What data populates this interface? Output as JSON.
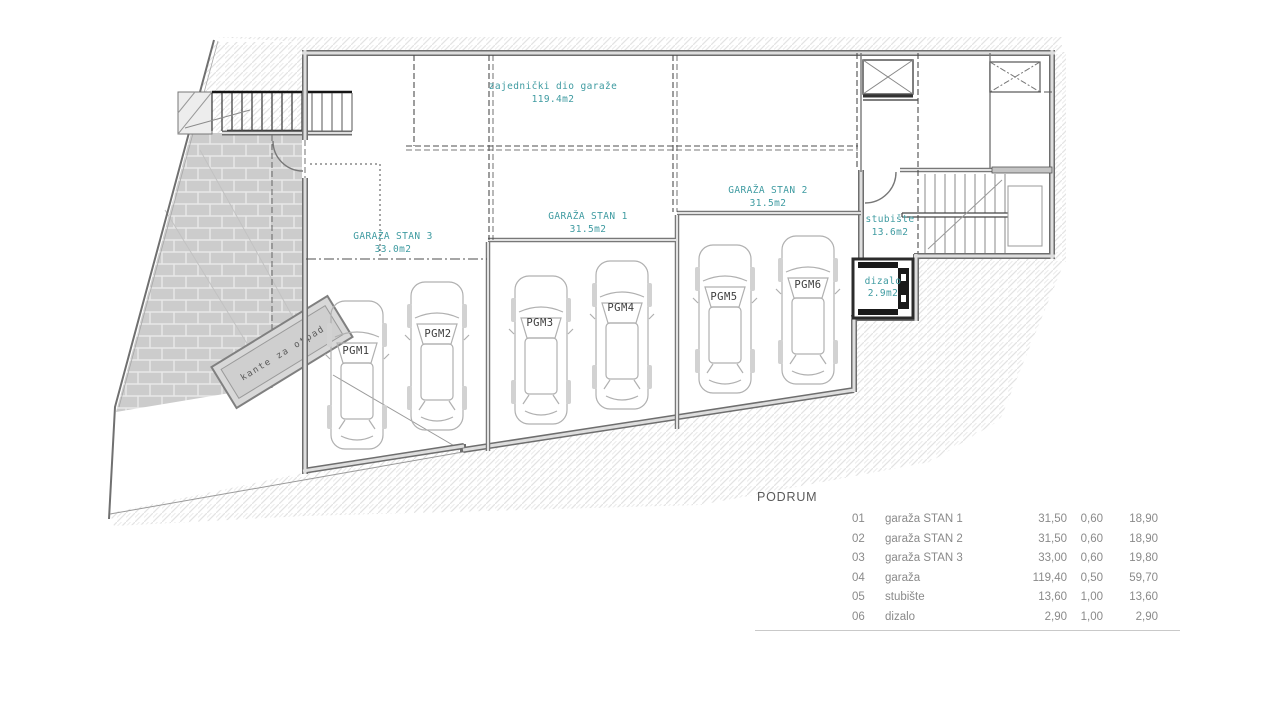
{
  "plan": {
    "accent_color": "#3f9ba1",
    "zones": {
      "common": {
        "name": "zajednički dio garaže",
        "area": "119.4m2"
      },
      "stan1": {
        "name": "GARAŽA STAN 1",
        "area": "31.5m2"
      },
      "stan2": {
        "name": "GARAŽA STAN 2",
        "area": "31.5m2"
      },
      "stan3": {
        "name": "GARAŽA STAN 3",
        "area": "33.0m2"
      },
      "stairwell": {
        "name": "stubište",
        "area": "13.6m2"
      },
      "elevator": {
        "name": "dizalo",
        "area": "2.9m2"
      },
      "waste": {
        "name": "kante za otpad"
      }
    },
    "parking": [
      "PGM1",
      "PGM2",
      "PGM3",
      "PGM4",
      "PGM5",
      "PGM6"
    ]
  },
  "table": {
    "heading": "PODRUM",
    "rows": [
      {
        "num": "01",
        "name": "garaža STAN 1",
        "area": "31,50",
        "coef": "0,60",
        "total": "18,90"
      },
      {
        "num": "02",
        "name": "garaža STAN 2",
        "area": "31,50",
        "coef": "0,60",
        "total": "18,90"
      },
      {
        "num": "03",
        "name": "garaža STAN 3",
        "area": "33,00",
        "coef": "0,60",
        "total": "19,80"
      },
      {
        "num": "04",
        "name": "garaža",
        "area": "119,40",
        "coef": "0,50",
        "total": "59,70"
      },
      {
        "num": "05",
        "name": "stubište",
        "area": "13,60",
        "coef": "1,00",
        "total": "13,60"
      },
      {
        "num": "06",
        "name": "dizalo",
        "area": "2,90",
        "coef": "1,00",
        "total": "2,90"
      }
    ]
  }
}
